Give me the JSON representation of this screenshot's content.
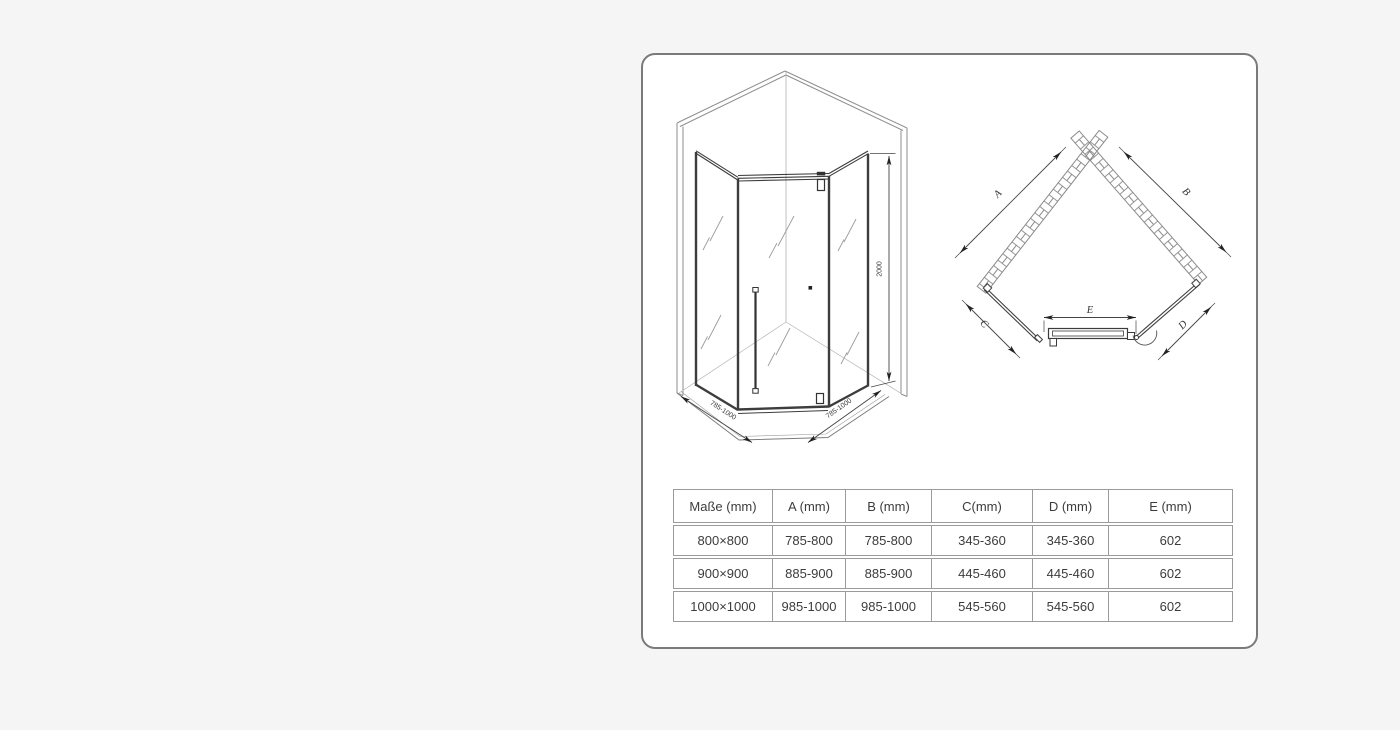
{
  "iso_view": {
    "dim_width_left": "785-1000",
    "dim_width_right": "785-1000",
    "dim_height": "2000"
  },
  "plan_view": {
    "label_a": "A",
    "label_b": "B",
    "label_c": "C",
    "label_d": "D",
    "label_e": "E"
  },
  "table": {
    "headers": [
      "Maße (mm)",
      "A (mm)",
      "B (mm)",
      "C(mm)",
      "D (mm)",
      "E (mm)"
    ],
    "rows": [
      [
        "800×800",
        "785-800",
        "785-800",
        "345-360",
        "345-360",
        "602"
      ],
      [
        "900×900",
        "885-900",
        "885-900",
        "445-460",
        "445-460",
        "602"
      ],
      [
        "1000×1000",
        "985-1000",
        "985-1000",
        "545-560",
        "545-560",
        "602"
      ]
    ]
  },
  "colors": {
    "page_background": "#f5f5f5",
    "panel_background": "#ffffff",
    "panel_border": "#7a7a7a",
    "frame_line": "#3d3d3d",
    "wall_line": "#8e8e8e",
    "dimension_line": "#444444",
    "table_border": "#9b9b9b",
    "text": "#3c3c3c"
  }
}
